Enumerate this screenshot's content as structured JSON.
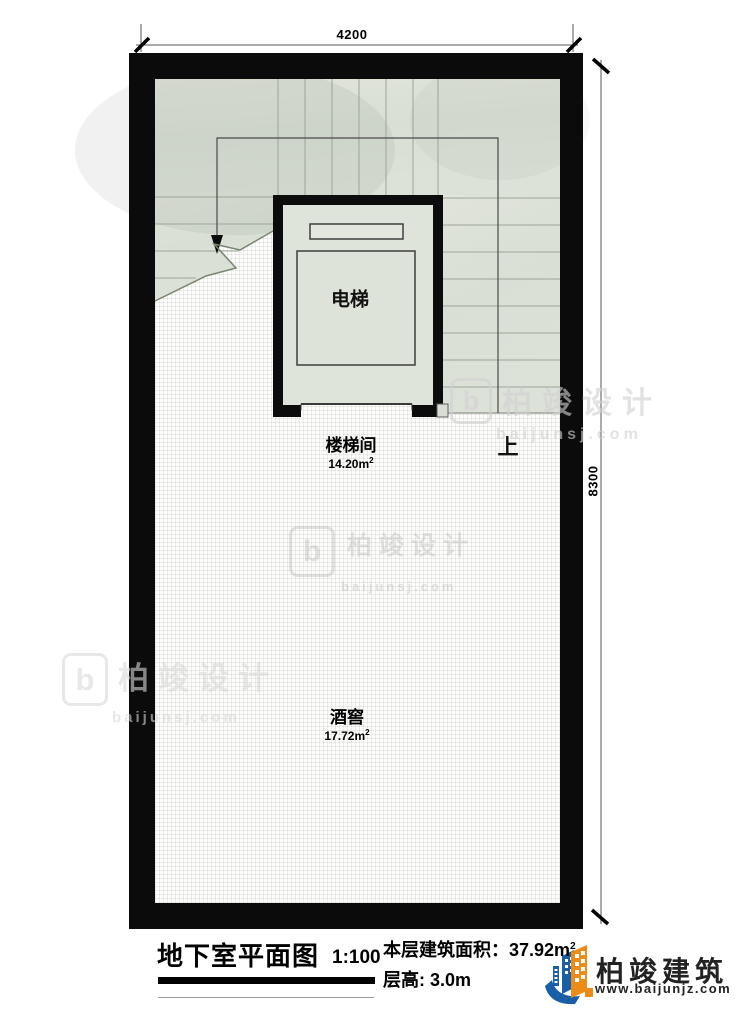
{
  "plan": {
    "rooms": {
      "elevator": {
        "label": "电梯"
      },
      "stairwell": {
        "label": "楼梯间",
        "area": "14.20m",
        "area_sup": "2"
      },
      "wine_cellar": {
        "label": "酒窖",
        "area": "17.72m",
        "area_sup": "2"
      },
      "direction_up": {
        "label": "上"
      }
    },
    "dimensions": {
      "top": "4200",
      "right": "8300"
    }
  },
  "footer": {
    "title": "地下室平面图",
    "scale": "1:100",
    "area_label": "本层建筑面积：",
    "area_value": "37.92m",
    "area_sup": "2",
    "floor_height": "层高: 3.0m"
  },
  "brand": {
    "name": "柏竣建筑",
    "website": "www.baijunjz.com"
  },
  "watermark": {
    "logo_letter": "b",
    "title": "柏竣设计",
    "site": "baijunsj.com"
  },
  "colors": {
    "wall": "#0b0b0b",
    "stair_fill": "#dce1d6",
    "tread_line": "#9ba698",
    "brand_blue": "#1b5ea8",
    "brand_orange": "#ec8c18"
  }
}
